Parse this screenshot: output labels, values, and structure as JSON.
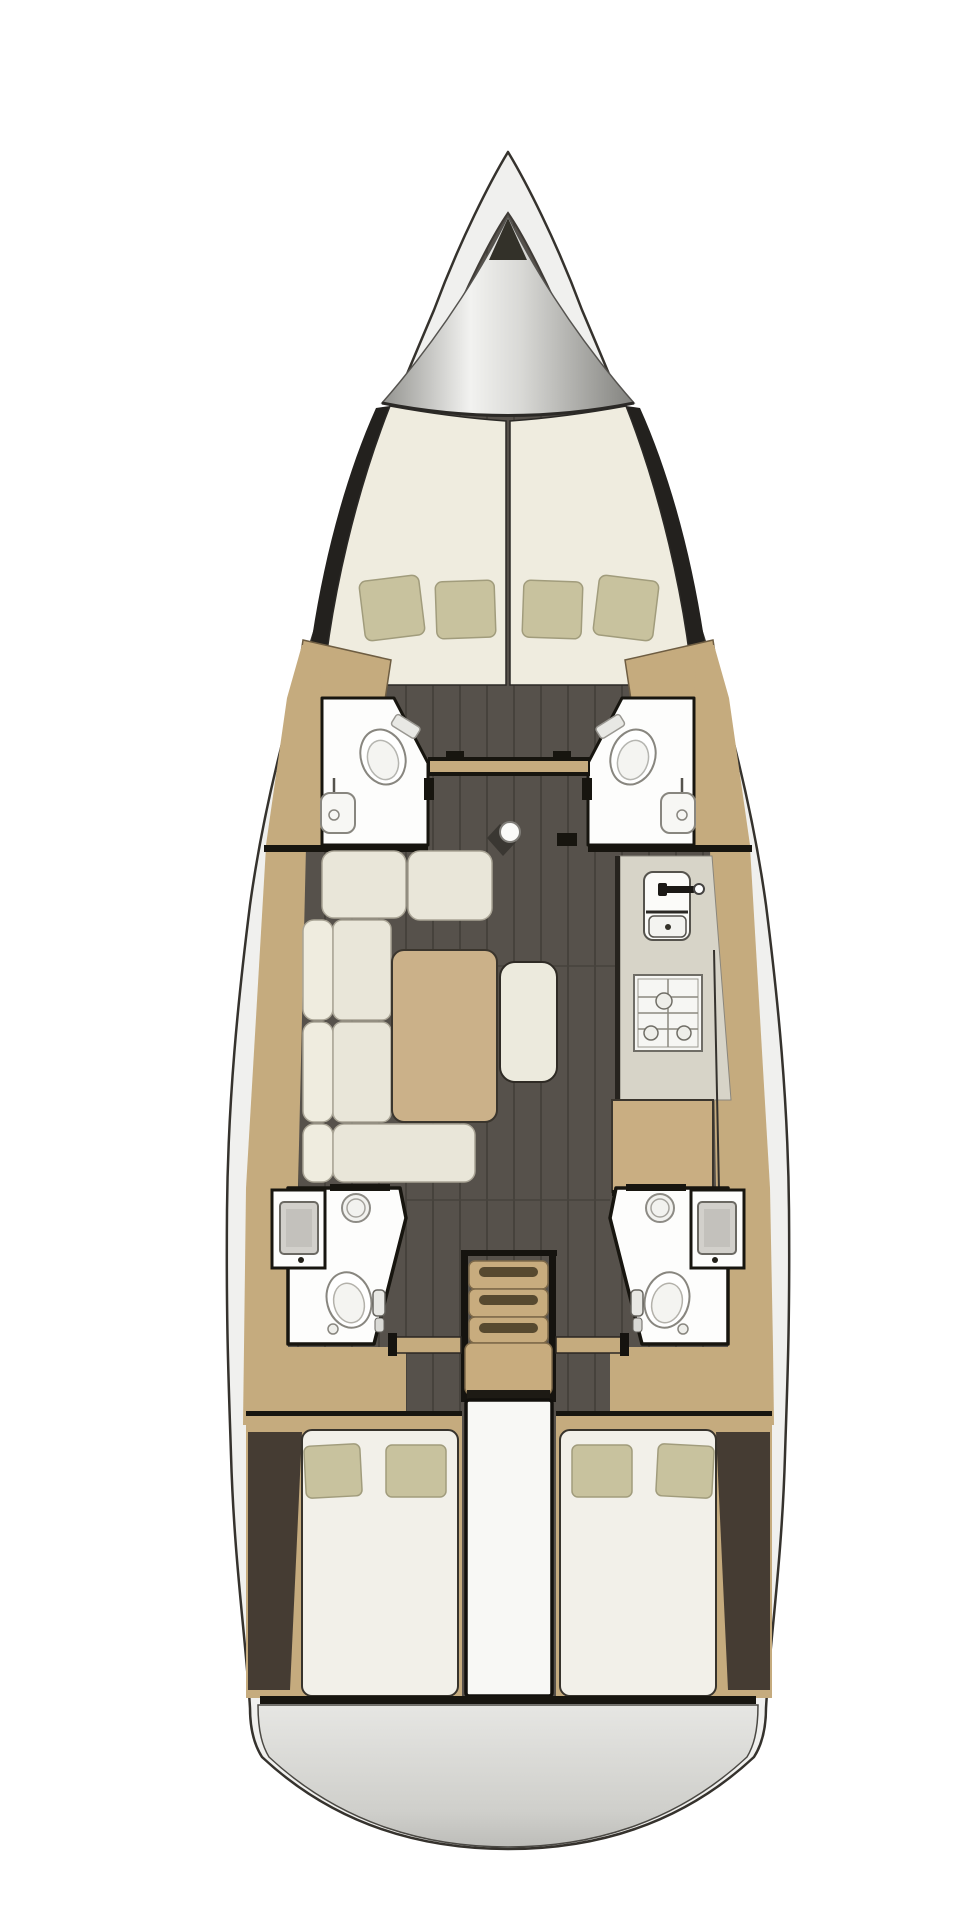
{
  "diagram": {
    "type": "yacht-interior-floor-plan",
    "view": "top-down",
    "orientation": "bow-up",
    "rooms": [
      {
        "id": "anchor-locker",
        "label": "Anchor locker"
      },
      {
        "id": "forward-cabin",
        "label": "Forward V-berth cabin",
        "features": [
          "split double berth",
          "4 pillows",
          "2 wardrobes"
        ]
      },
      {
        "id": "port-forward-head",
        "label": "Port forward head",
        "features": [
          "toilet",
          "sink",
          "door"
        ]
      },
      {
        "id": "starboard-forward-head",
        "label": "Starboard forward head",
        "features": [
          "toilet",
          "sink",
          "door"
        ]
      },
      {
        "id": "saloon",
        "label": "Saloon",
        "features": [
          "L-shaped sofa",
          "dining table",
          "bench seat",
          "mast post"
        ]
      },
      {
        "id": "galley",
        "label": "Galley",
        "features": [
          "double sink",
          "faucet",
          "3-burner stove",
          "counter"
        ]
      },
      {
        "id": "nav-station",
        "label": "Chart table"
      },
      {
        "id": "port-aft-head",
        "label": "Port aft head",
        "features": [
          "sink",
          "shower drain",
          "toilet",
          "hand shower"
        ]
      },
      {
        "id": "starboard-aft-head",
        "label": "Starboard aft head",
        "features": [
          "sink",
          "shower drain",
          "toilet",
          "hand shower"
        ]
      },
      {
        "id": "companionway",
        "label": "Companionway stairs",
        "steps": 4
      },
      {
        "id": "engine-compartment",
        "label": "Engine compartment"
      },
      {
        "id": "port-aft-cabin",
        "label": "Port aft cabin",
        "features": [
          "double berth",
          "2 pillows"
        ]
      },
      {
        "id": "starboard-aft-cabin",
        "label": "Starboard aft cabin",
        "features": [
          "double berth",
          "2 pillows"
        ]
      },
      {
        "id": "swim-platform",
        "label": "Transom / swim platform"
      }
    ],
    "fixtures": {
      "toilets": 4,
      "sinks": 5,
      "shower_drains": 2,
      "stove_burners": 3,
      "companionway_steps": 4,
      "v_berth_pillows": 4,
      "aft_cabin_pillows": 4
    }
  },
  "colors": {
    "page": "#ffffff",
    "hull": "#f0f0ee",
    "outline": "#35322d",
    "interior_line": "#3f3b36",
    "floor": "#56514b",
    "floor_seam": "#46423c",
    "wood": "#c5ab7e",
    "wood_edge": "#6e5d42",
    "mattress": "#efecdf",
    "berth_white": "#f2f0e9",
    "cushion": "#e9e6d9",
    "cushion_edge": "#a9a495",
    "pillow": "#c8c29e",
    "pillow_edge": "#a19c7c",
    "bath": "#fdfdfc",
    "wall": "#17150f",
    "fixture_line": "#88867f",
    "counter": "#d7d4c8",
    "stove": "#f6f6f3",
    "steps": "#c8ac7e",
    "step_slot": "#57492f",
    "engine_box": "#f8f8f5",
    "platform_light": "#e6e6e3",
    "platform_dark": "#bdbdb9",
    "locker_dark": "#8f8f8c",
    "locker_light": "#f2f2f0",
    "wedge": "#453c33",
    "shadow": "#23211e"
  }
}
